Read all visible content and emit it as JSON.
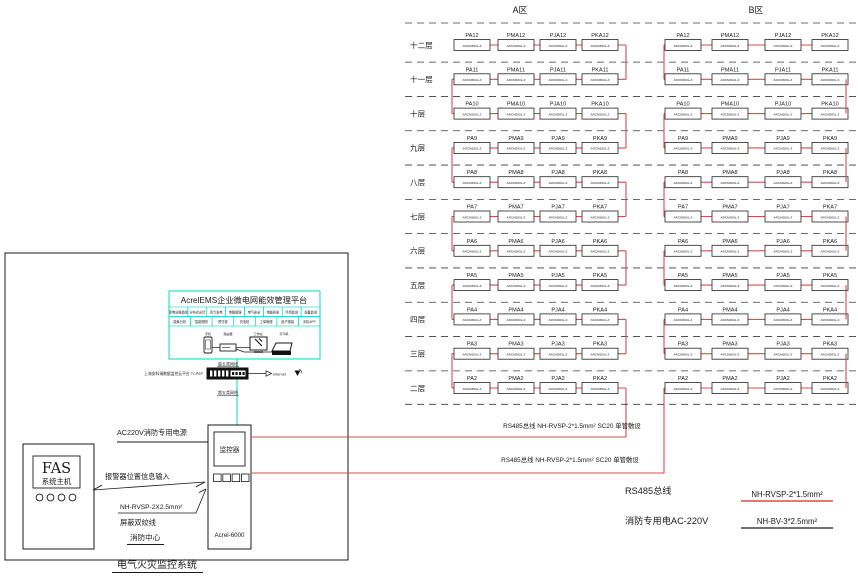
{
  "diagram_title": "电气火灾监控系统",
  "zones": {
    "a": "A区",
    "b": "B区"
  },
  "floors": [
    {
      "label": "十二层",
      "num": "12"
    },
    {
      "label": "十一层",
      "num": "11"
    },
    {
      "label": "十层",
      "num": "10"
    },
    {
      "label": "九层",
      "num": "9"
    },
    {
      "label": "八层",
      "num": "8"
    },
    {
      "label": "七层",
      "num": "7"
    },
    {
      "label": "六层",
      "num": "6"
    },
    {
      "label": "五层",
      "num": "5"
    },
    {
      "label": "四层",
      "num": "4"
    },
    {
      "label": "三层",
      "num": "3"
    },
    {
      "label": "二层",
      "num": "2"
    }
  ],
  "device_prefixes": [
    "PA",
    "PMA",
    "PJA",
    "PKA"
  ],
  "device_model": "ARCM300L-Z",
  "bus": {
    "bus1_label": "RS485总线 NH-RVSP-2*1.5mm² SC20 单管敷设",
    "bus2_label": "RS485总线 NH-RVSP-2*1.5mm² SC20 单管敷设"
  },
  "legend": {
    "rs485": "RS485总线",
    "power": "消防专用电AC-220V",
    "rs485_cable": "NH-RVSP-2*1.5mm²",
    "power_cable": "NH-BV-3*2.5mm²"
  },
  "platform": {
    "title": "AcrelEMS企业微电网能效管理平台",
    "modules_row1": [
      "变电运维监控",
      "分布式光伏",
      "风力发电",
      "电能管理",
      "电气安全",
      "电能质量",
      "环境监测",
      "设备监测"
    ],
    "modules_row2": [
      "能耗分析",
      "智能照明",
      "预付费",
      "充电桩",
      "工单管理",
      "用户报装",
      "手机APP"
    ],
    "devices": [
      "手机",
      "路由器",
      "工作站",
      "打印机"
    ]
  },
  "network": {
    "upload_note": "上海安科瑞数据监控云平台 TCP/IP",
    "cable_label_top": "超五类网线",
    "cable_label_bottom": "超五类网线",
    "internet": "Internet"
  },
  "monitor": {
    "screen": "监控器",
    "model": "Acrel-6000"
  },
  "fas": {
    "name": "FAS",
    "subtitle": "系统主机"
  },
  "labels": {
    "ac220": "AC220V消防专用电源",
    "alarm_input": "报警器位置信息输入",
    "cable": "NH-RVSP-2X2.5mm²",
    "shielded": "屏蔽双绞线",
    "fire_center": "消防中心"
  },
  "colors": {
    "wire_red": "#d84c4c",
    "teal": "#00d8c4",
    "line_black": "#1a1a1a"
  }
}
